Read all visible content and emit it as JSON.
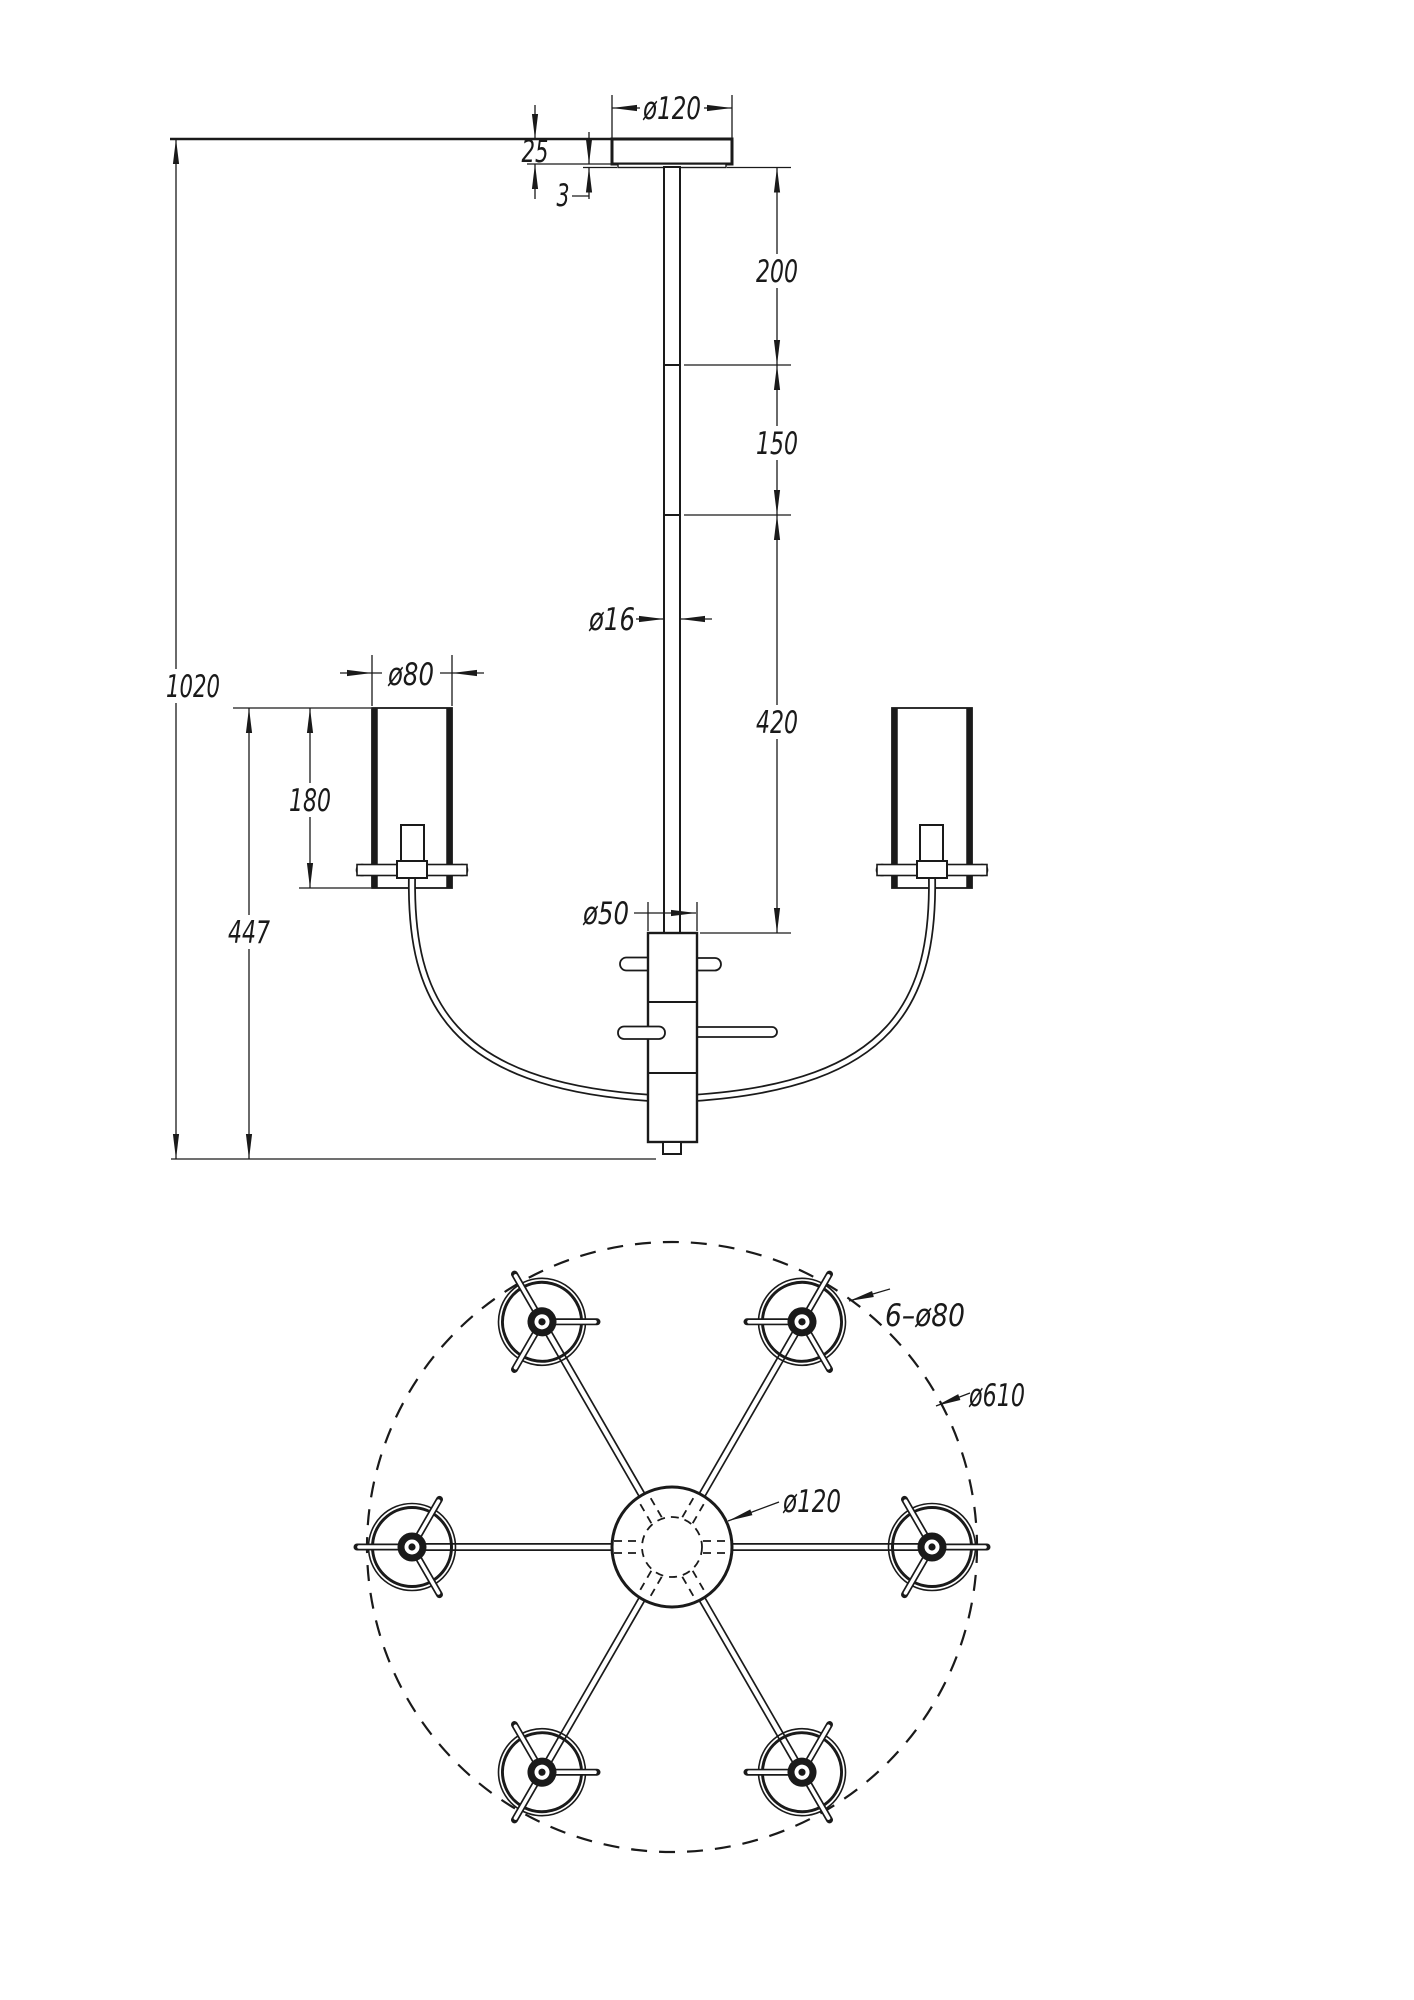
{
  "drawing": {
    "front_view": {
      "dims": {
        "canopy_diameter": "ø120",
        "canopy_height": "25",
        "canopy_lip": "3",
        "rod_segment_top": "200",
        "rod_segment_mid": "150",
        "rod_segment_bottom": "420",
        "rod_diameter": "ø16",
        "shade_diameter": "ø80",
        "shade_height": "180",
        "hub_diameter": "ø50",
        "drop_to_shade_top": "447",
        "total_height": "1020"
      }
    },
    "plan_view": {
      "dims": {
        "shades_count_diameter": "6–ø80",
        "overall_diameter": "ø610",
        "canopy_diameter": "ø120"
      }
    }
  }
}
